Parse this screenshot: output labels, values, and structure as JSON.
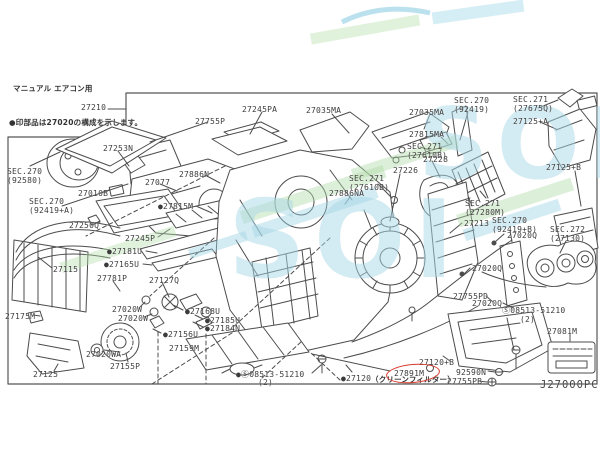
{
  "watermark": {
    "text": "SOI"
  },
  "diagram": {
    "title": "マニュアル エアコン用",
    "note": "●印部品は27020の構成を示します。",
    "assembly": "27210",
    "code": "J27000PC",
    "highlight_part": "27891M",
    "labels": [
      "27253N",
      "SEC.270\n(92580)",
      "27077",
      "27010B",
      "SEC.270\n(92419+A)",
      "27886N",
      "27755P",
      "27245PA",
      "27035MA",
      "27035MA",
      "SEC.270\n(92419)",
      "SEC.271\n(27675Q)",
      "27125+A",
      "27815MA",
      "SEC.271\n(27610B)",
      "27228",
      "27226",
      "SEC.271\n(27610B)",
      "27886NA",
      "●27815M",
      "27250Q",
      "27245P",
      "●27181U",
      "●27165U",
      "27781P",
      "27127Q",
      "27115",
      "27175M",
      "27020W",
      "27020W",
      "●27168U",
      "●27185U",
      "●27184N",
      "●27156U",
      "27159M",
      "27020WA",
      "27155P",
      "27125",
      "●Ⓢ08513-51210",
      "(2)",
      "27213",
      "27020Q",
      "27020Q",
      "27020Q",
      "27755PD",
      "SEC.271\n(27280M)",
      "SEC.270\n(92419+B)",
      "SEC.272\n(27130)",
      "27125+B",
      "Ⓢ08513-51210",
      "(2)",
      "92590N",
      "27755PB",
      "27120+B",
      "●27120",
      "（クリーンフィルター）",
      "27891M",
      "27081M"
    ]
  }
}
